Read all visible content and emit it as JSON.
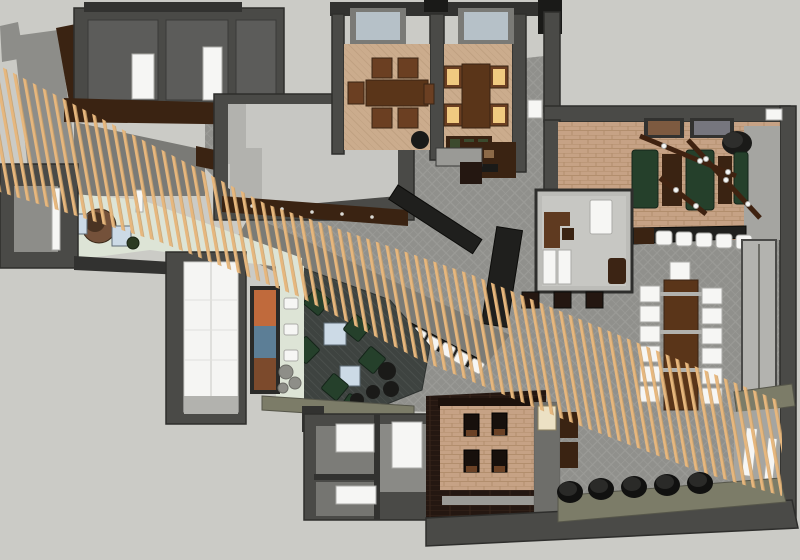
{
  "scene": {
    "type": "3d-floorplan-top-view",
    "description": "Top-down 3D rendering of a restaurant interior floor plan crossed by a long diagonal wooden slat screen"
  },
  "colors": {
    "canvas": "#cbcbc6",
    "wall": "#4a4a47",
    "wall_dark": "#323230",
    "wall_light": "#7a7a76",
    "wall_top": "#8d8d89",
    "floor_tile": "#90908c",
    "floor_tile_line": "#9b9b97",
    "floor_room": "#5c5c5a",
    "floor_light": "#c7c7c3",
    "steel": "#b2b2ae",
    "mint": "#dde4d6",
    "slat": "#e7b77d",
    "slat_edge": "#c99e66",
    "brick": "#c6a285",
    "brick_line": "#b28e6d",
    "carpet": "#cbac8d",
    "carpet_line": "#bfa081",
    "wood": "#5a3519",
    "wood_dark": "#3a2312",
    "wood_deep": "#241711",
    "plank_line": "#37261a",
    "chair_wood": "#6b3f22",
    "booth_green": "#25402b",
    "lit_seat": "#f0ca80",
    "blue_seat": "#ccdae6",
    "olive": "#7c7c68",
    "lounge_carpet": "#3e4340",
    "lounge_line": "#4a4f4c",
    "black": "#1a1a18",
    "dark_furniture": "#1f1f1d",
    "glass": "#b6c1c8",
    "cream": "#ece1c4",
    "stone": "#8e8e88",
    "gray_floor_door": "#a5a5a1",
    "bar_zone": "#7b7b76",
    "white": "#f6f6f4",
    "mural_orange": "#c06a3c",
    "mural_blue": "#5c7e96",
    "mural_brown": "#7c4a2c"
  },
  "objects": {
    "private_dining_left_chairs": 6,
    "private_dining_right_lit_chairs": 4,
    "games_room_green_booths": 3,
    "games_room_wood_tables": 2,
    "games_room_wall_pictures": 2,
    "games_room_pendant_rails": 3,
    "games_room_counter_stools": 5,
    "communal_table_side_chairs": 12,
    "communal_table_head_chairs": 1,
    "diagonal_bar_chairs": 8,
    "lounge_green_armchairs": 6,
    "lounge_blue_side_tables": 2,
    "lounge_round_poufs": 4,
    "reception_blue_chairs": 2,
    "brick_nook_booth_tables": 4,
    "black_cylinder_poufs": 5,
    "restroom_door_openings": 3,
    "skylights": 2
  }
}
